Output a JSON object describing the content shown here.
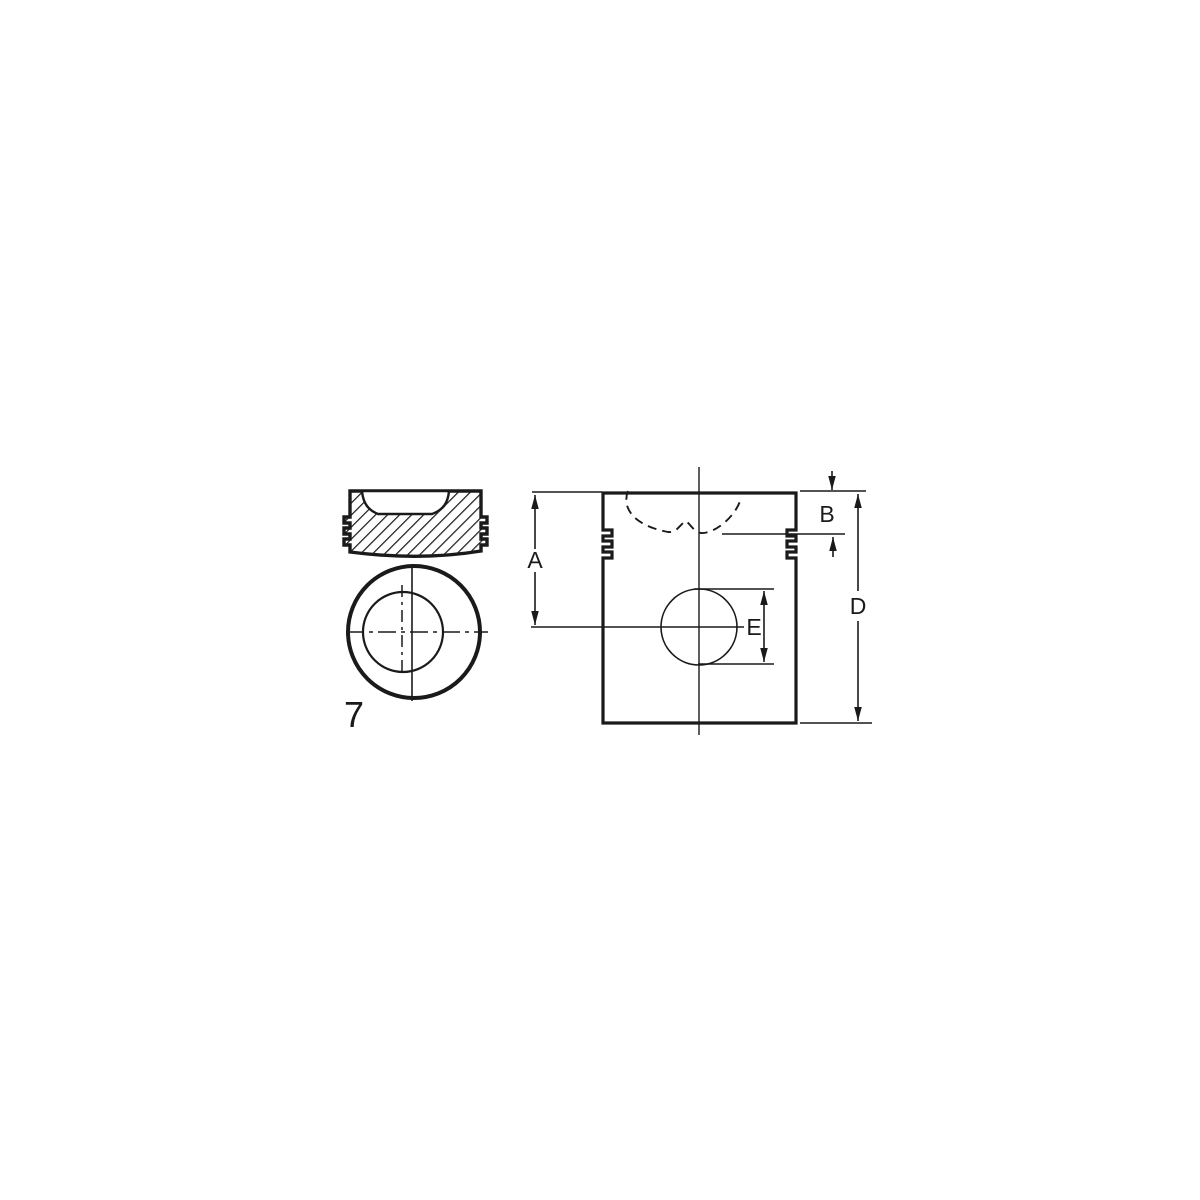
{
  "diagram": {
    "figure_number": "7",
    "dimension_labels": {
      "a": "A",
      "b": "B",
      "d": "D",
      "e": "E"
    },
    "colors": {
      "line": "#1a1a1a",
      "background": "#ffffff"
    }
  }
}
